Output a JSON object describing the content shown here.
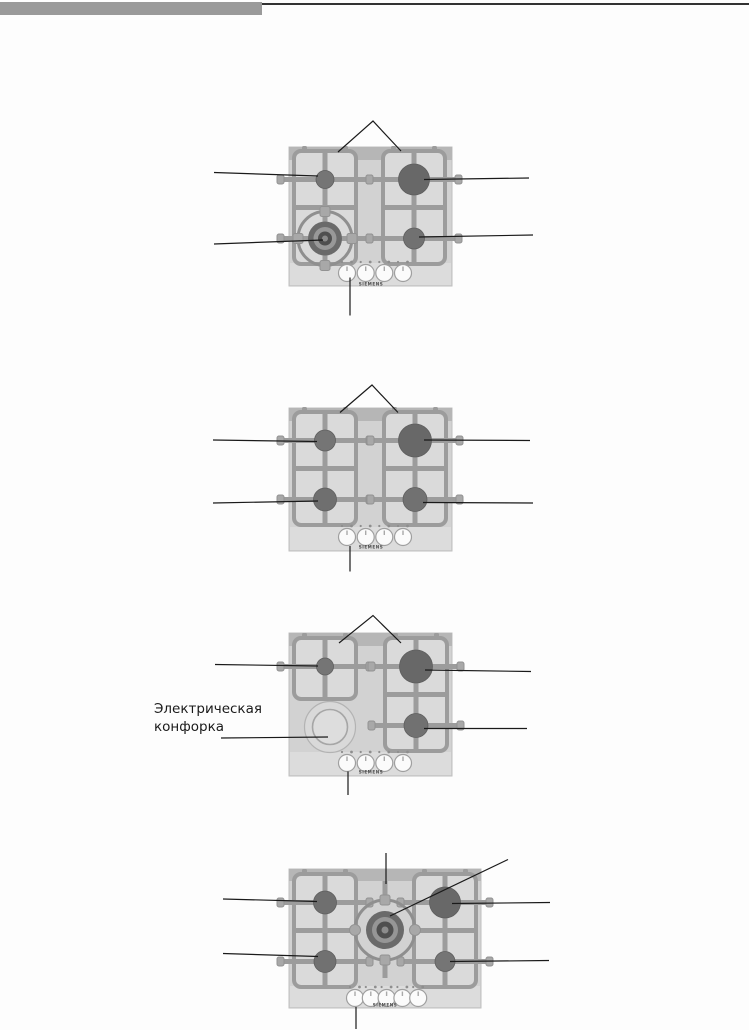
{
  "brand": "SIEMENS",
  "electric_label": {
    "line1": "Электрическая",
    "line2": "конфорка"
  },
  "figures": [
    {
      "id": 1,
      "description": "gas-hob-4-burners-with-wok-burner",
      "knob_count": 4,
      "burner_count": 4
    },
    {
      "id": 2,
      "description": "gas-hob-4-burners",
      "knob_count": 4,
      "burner_count": 4
    },
    {
      "id": 3,
      "description": "gas-hob-3-gas-burners-plus-electric-plate",
      "knob_count": 4,
      "burner_count": 4
    },
    {
      "id": 4,
      "description": "gas-hob-70cm-4-burners-plus-central-wok-burner",
      "knob_count": 5,
      "burner_count": 5
    }
  ],
  "colors": {
    "header_bar": "#9a9a9a",
    "header_rule": "#323232",
    "hob_body": "#d2d2d2",
    "hob_top_strip": "#b6b6b6",
    "hob_control_band": "#dcdcdc",
    "grate": "#9c9c9c",
    "burner_large": "#686868",
    "burner_medium": "#6f6f6f",
    "burner_small": "#757575",
    "knob_face": "#fbfbfb",
    "callout_line": "#1a1a1a",
    "label_text": "#1a1a1a"
  }
}
